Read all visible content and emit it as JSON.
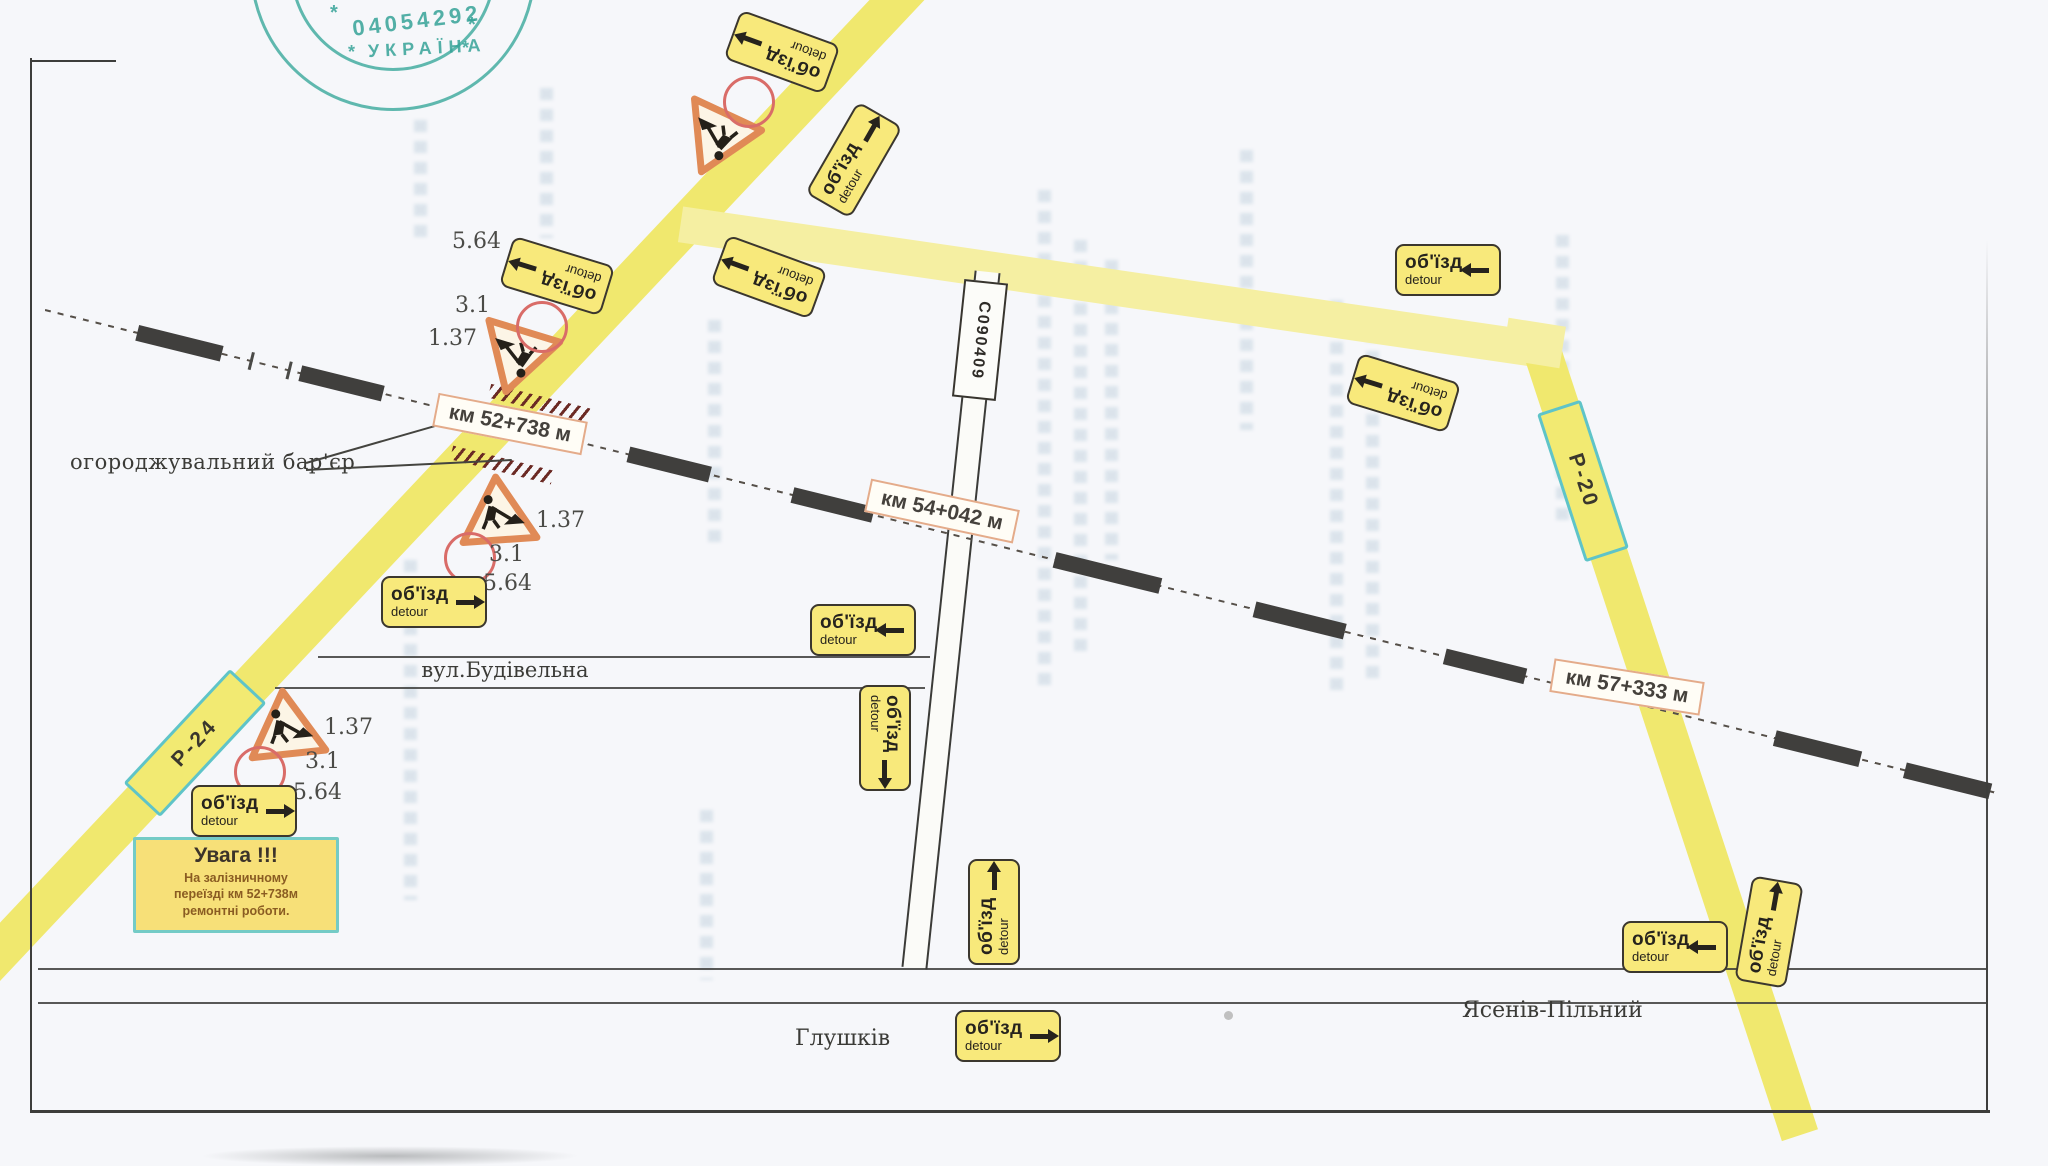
{
  "stamp": {
    "number": "04054292",
    "country": "УКРАЇНА",
    "star": "*"
  },
  "notice": {
    "title": "Увага !!!",
    "lines": [
      "На залізничному",
      "переїзді км 52+738м",
      "ремонтні роботи."
    ]
  },
  "km": [
    "км 52+738 м",
    "км 54+042 м",
    "км 57+333 м"
  ],
  "codes": {
    "top": [
      "5.64",
      "3.1",
      "1.37"
    ],
    "mid": [
      "1.37",
      "3.1",
      "5.64"
    ],
    "bottom": [
      "1.37",
      "3.1",
      "5.64"
    ]
  },
  "detour": {
    "uk": "об'їзд",
    "en": "detour"
  },
  "routes": {
    "p24": "Р-24",
    "p20": "Р-20",
    "local": "С090409"
  },
  "labels": {
    "barrier": "огороджувальний бар'єр",
    "street": "вул.Будівельна",
    "glushkiv": "Глушків",
    "yaseniv": "Ясенів-Пільний"
  }
}
